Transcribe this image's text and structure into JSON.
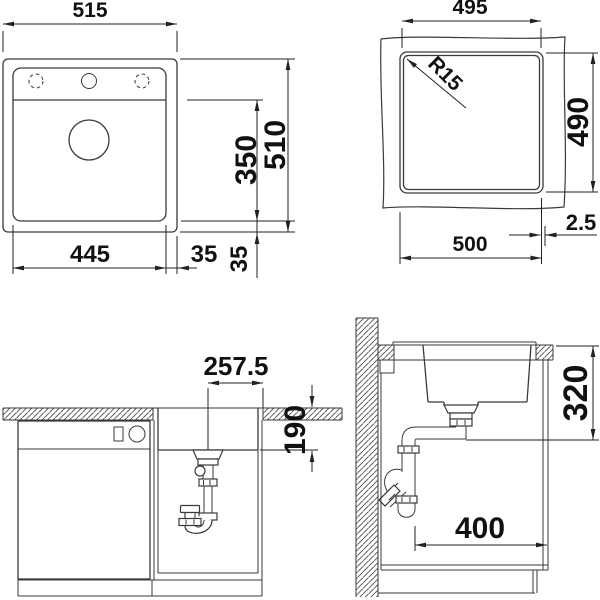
{
  "drawing": {
    "background": "#ffffff",
    "line_color": "#3a3a3a",
    "text_color": "#111111",
    "views": {
      "top": {
        "name": "sink top view",
        "dims": {
          "overall_width": "515",
          "overall_height": "510",
          "bowl_width": "445",
          "bowl_depth": "350",
          "rim_right": "35",
          "rim_bottom": "35"
        }
      },
      "cutout": {
        "name": "countertop cutout view",
        "dims": {
          "cutout_width_top": "495",
          "cutout_height": "490",
          "corner_radius": "R15",
          "cutout_width_bottom": "500",
          "edge_gap": "2.5"
        }
      },
      "front": {
        "name": "front elevation",
        "dims": {
          "drain_center_offset": "257.5",
          "bowl_inset_depth": "190"
        }
      },
      "side": {
        "name": "side section",
        "dims": {
          "drain_height": "320",
          "drain_distance": "400"
        }
      }
    }
  }
}
